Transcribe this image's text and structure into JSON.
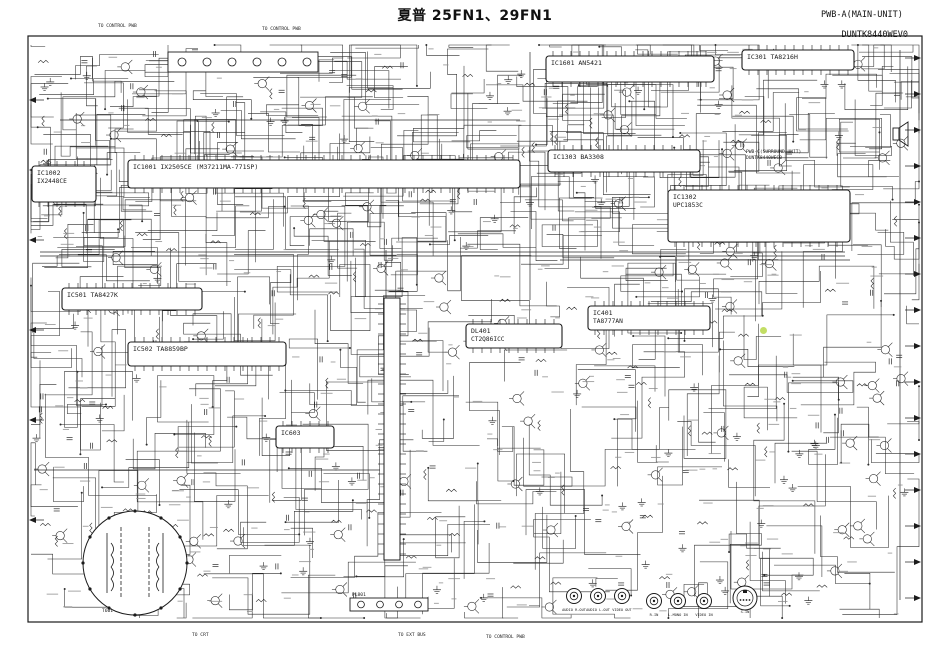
{
  "title": "夏普 25FN1、29FN1",
  "board": {
    "line1": "PWB-A(MAIN-UNIT)",
    "line2": "DUNTK8440WEV0"
  },
  "colors": {
    "ink": "#1b1b1b",
    "wire": "#2b2b2b",
    "smudge": "#8a8a8a",
    "paper": "#ffffff",
    "highlight": "#b8d84a"
  },
  "components": [
    {
      "id": "IC1001",
      "part": "IX2505CE (M37211MA-771SP)",
      "x": 128,
      "y": 160,
      "w": 392,
      "h": 28
    },
    {
      "id": "IC1002",
      "part": "IX2448CE",
      "x": 32,
      "y": 166,
      "w": 64,
      "h": 36,
      "twoLine": true
    },
    {
      "id": "IC1601",
      "part": "AN5421",
      "x": 546,
      "y": 56,
      "w": 168,
      "h": 26
    },
    {
      "id": "IC301",
      "part": "TA8216H",
      "x": 742,
      "y": 50,
      "w": 112,
      "h": 20
    },
    {
      "id": "IC1303",
      "part": "BA3308",
      "x": 548,
      "y": 150,
      "w": 152,
      "h": 22
    },
    {
      "id": "IC1302",
      "part": "UPC1853C",
      "x": 668,
      "y": 190,
      "w": 182,
      "h": 52,
      "twoLine": true
    },
    {
      "id": "IC501",
      "part": "TA8427K",
      "x": 62,
      "y": 288,
      "w": 140,
      "h": 22
    },
    {
      "id": "IC502",
      "part": "TA8859BP",
      "x": 128,
      "y": 342,
      "w": 158,
      "h": 24
    },
    {
      "id": "IC603",
      "part": "",
      "x": 276,
      "y": 426,
      "w": 58,
      "h": 22
    },
    {
      "id": "IC401",
      "part": "TA8777AN",
      "x": 588,
      "y": 306,
      "w": 122,
      "h": 24,
      "twoLine": true
    },
    {
      "id": "DL401",
      "part": "CT2Q86ICC",
      "x": 466,
      "y": 324,
      "w": 96,
      "h": 24,
      "twoLine": true
    }
  ],
  "notes": [
    {
      "text": "TO CONTROL PWB",
      "x": 98,
      "y": 27,
      "s": 4.6
    },
    {
      "text": "TO CONTROL PWB",
      "x": 262,
      "y": 30,
      "s": 4.6
    },
    {
      "text": "PWB-C(SURROUND-UNIT)",
      "x": 746,
      "y": 153,
      "s": 4.6
    },
    {
      "text": "DUNTK8440WEC0",
      "x": 746,
      "y": 159,
      "s": 4.6
    },
    {
      "text": "T601",
      "x": 102,
      "y": 612,
      "s": 4.6
    },
    {
      "text": "TO CRT",
      "x": 192,
      "y": 636,
      "s": 4.6
    },
    {
      "text": "PL801",
      "x": 352,
      "y": 596,
      "s": 4.6
    },
    {
      "text": "TO EXT BUS",
      "x": 398,
      "y": 636,
      "s": 4.6
    },
    {
      "text": "TO CONTROL PWB",
      "x": 486,
      "y": 638,
      "s": 4.6
    }
  ],
  "jacks": [
    {
      "label": "AUDIO R-OUT",
      "x": 574,
      "y": 596,
      "type": "rca"
    },
    {
      "label": "AUDIO L-OUT",
      "x": 598,
      "y": 596,
      "type": "rca"
    },
    {
      "label": "VIDEO OUT",
      "x": 622,
      "y": 596,
      "type": "rca"
    },
    {
      "label": "R-IN",
      "x": 654,
      "y": 601,
      "type": "rca"
    },
    {
      "label": "L-MONO IN",
      "x": 678,
      "y": 601,
      "type": "rca"
    },
    {
      "label": "VIDEO IN",
      "x": 704,
      "y": 601,
      "type": "rca"
    },
    {
      "label": "S-IN",
      "x": 745,
      "y": 598,
      "type": "din"
    }
  ],
  "flyback": {
    "label": "T601",
    "cx": 135,
    "cy": 563,
    "r": 52
  },
  "highlight": {
    "x": 760,
    "y": 327
  }
}
